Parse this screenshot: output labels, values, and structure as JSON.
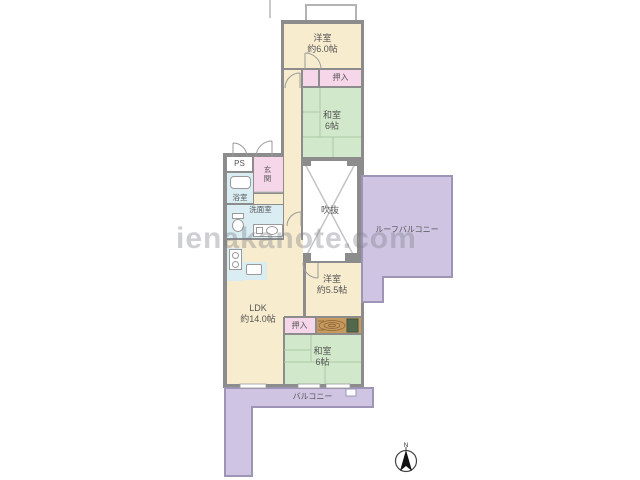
{
  "watermark": {
    "text": "ienakanote.com"
  },
  "compass": {
    "north_label": "N"
  },
  "rooms": {
    "yoshitsu_upper": {
      "label": "洋室",
      "size": "約6.0帖"
    },
    "oshiire_upper": {
      "label": "押入"
    },
    "washitsu_upper": {
      "label": "和室",
      "size": "6帖"
    },
    "ps": {
      "label": "PS"
    },
    "genkan": {
      "label": "玄関"
    },
    "yokushitsu": {
      "label": "浴室"
    },
    "senmenshitsu": {
      "label": "洗面室"
    },
    "fukinuke": {
      "label": "吹抜"
    },
    "roof_balcony": {
      "label": "ルーフバルコニー"
    },
    "ldk": {
      "label": "LDK",
      "size": "約14.0帖"
    },
    "yoshitsu_lower": {
      "label": "洋室",
      "size": "約5.5帖"
    },
    "oshiire_lower": {
      "label": "押入"
    },
    "washitsu_lower": {
      "label": "和室",
      "size": "6帖"
    },
    "balcony": {
      "label": "バルコニー"
    }
  },
  "colors": {
    "western_room_cream": "#f8ecce",
    "tatami_green": "#d2e8ca",
    "closet_pink": "#f6d7ea",
    "wet_area_blue": "#d9edf3",
    "balcony_purple": "#cfc5e3",
    "wall_gray": "#8c8c8c",
    "wood_alcove_brown": "#c79a5e",
    "void_white": "#ffffff"
  }
}
